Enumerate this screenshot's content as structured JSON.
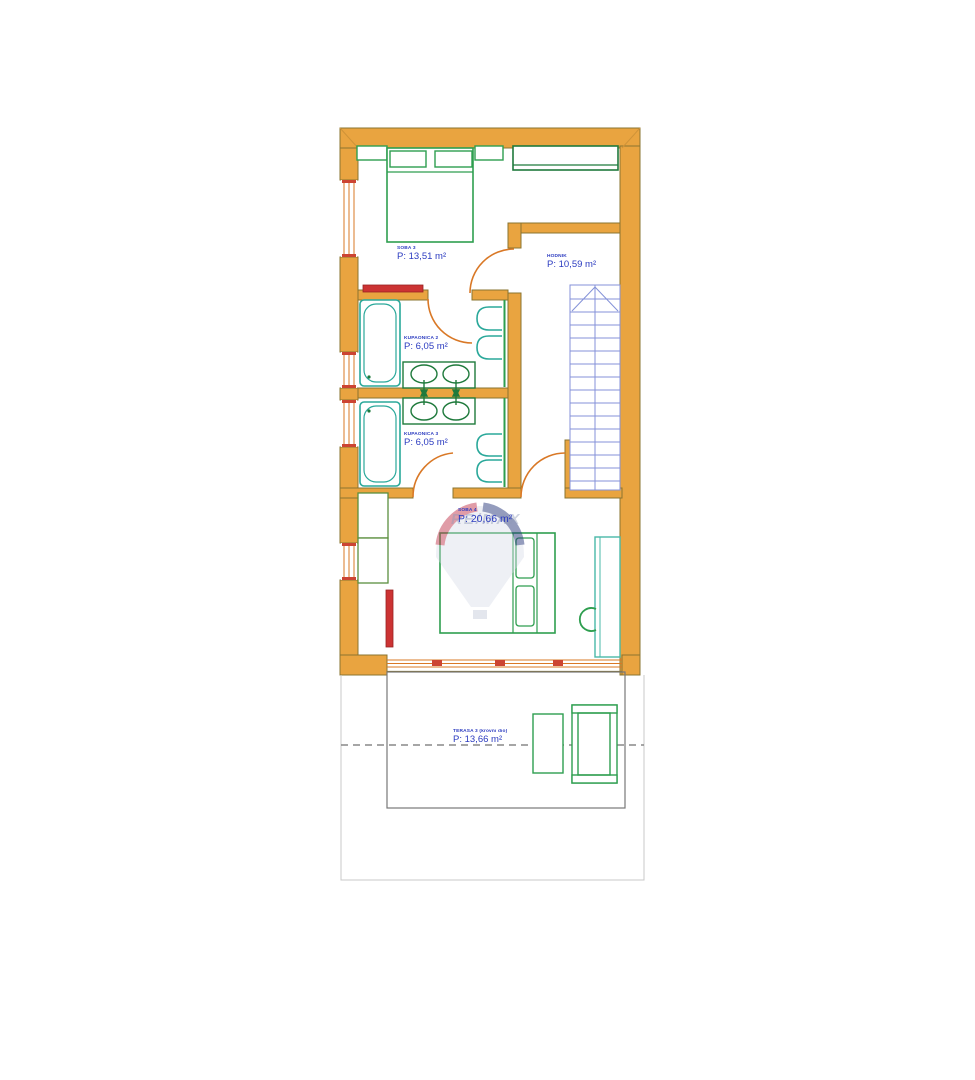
{
  "rooms": {
    "soba3": {
      "name": "SOBA 3",
      "area": "P: 13,51 m²"
    },
    "hodnik": {
      "name": "HODNIK",
      "area": "P: 10,59 m²"
    },
    "kupaonica2": {
      "name": "KUPAONICA 2",
      "area": "P: 6,05 m²"
    },
    "kupaonica3": {
      "name": "KUPAONICA 3",
      "area": "P: 6,05 m²"
    },
    "soba4": {
      "name": "SOBA 4",
      "area": "P: 20,66 m²"
    },
    "terasa3": {
      "name": "TERASA 3 (krovni dio)",
      "area": "P: 13,66 m²"
    }
  },
  "watermark": {
    "brand": "RE/MAX"
  },
  "colors": {
    "wall_fill": "#E9A440",
    "wall_outline": "#8A7430",
    "furniture_green": "#2E9E4F",
    "fixture_teal": "#2AA89A",
    "vanity_dark_green": "#1F7A3C",
    "stairs_blue": "#8492D8",
    "label_blue": "#2B3BC0",
    "radiator_red": "#CC3333",
    "terrace_outline": "#777777"
  }
}
